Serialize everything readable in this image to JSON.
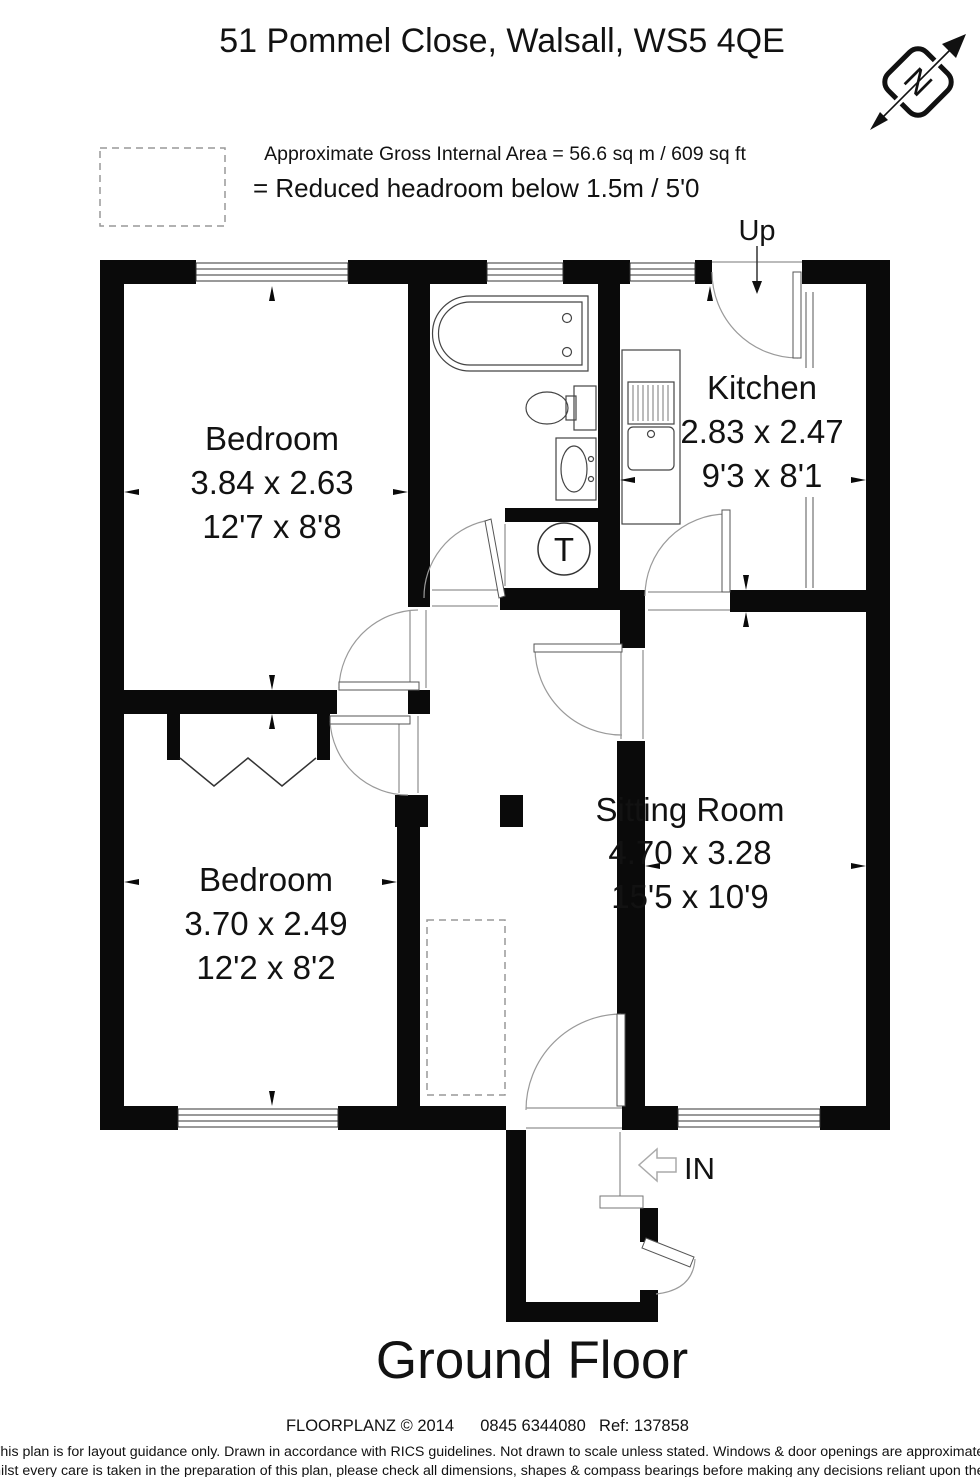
{
  "header": {
    "title": "51 Pommel Close, Walsall, WS5 4QE",
    "subtitle": "Approximate Gross Internal Area = 56.6 sq m / 609 sq ft",
    "legend_label": "= Reduced headroom below 1.5m / 5'0"
  },
  "compass": {
    "label": "N"
  },
  "plan": {
    "up_label": "Up",
    "in_label": "IN",
    "tank_label": "T",
    "rooms": [
      {
        "name": "Bedroom",
        "metric": "3.84 x 2.63",
        "imperial": "12'7 x 8'8"
      },
      {
        "name": "Kitchen",
        "metric": "2.83 x 2.47",
        "imperial": "9'3 x 8'1"
      },
      {
        "name": "Bedroom",
        "metric": "3.70 x 2.49",
        "imperial": "12'2 x 8'2"
      },
      {
        "name": "Sitting Room",
        "metric": "4.70 x 3.28",
        "imperial": "15'5 x 10'9"
      }
    ]
  },
  "footer": {
    "floor_label": "Ground Floor",
    "brand": "FLOORPLANZ © 2014",
    "phone": "0845 6344080",
    "ref": "Ref: 137858",
    "disclaimer_line1": "This plan is for layout guidance only. Drawn in accordance with RICS guidelines. Not drawn to scale unless stated. Windows & door openings are approximate.",
    "disclaimer_line2": "Whilst every care is taken in the preparation of this plan, please check all dimensions, shapes & compass bearings before making any decisions reliant upon them."
  }
}
